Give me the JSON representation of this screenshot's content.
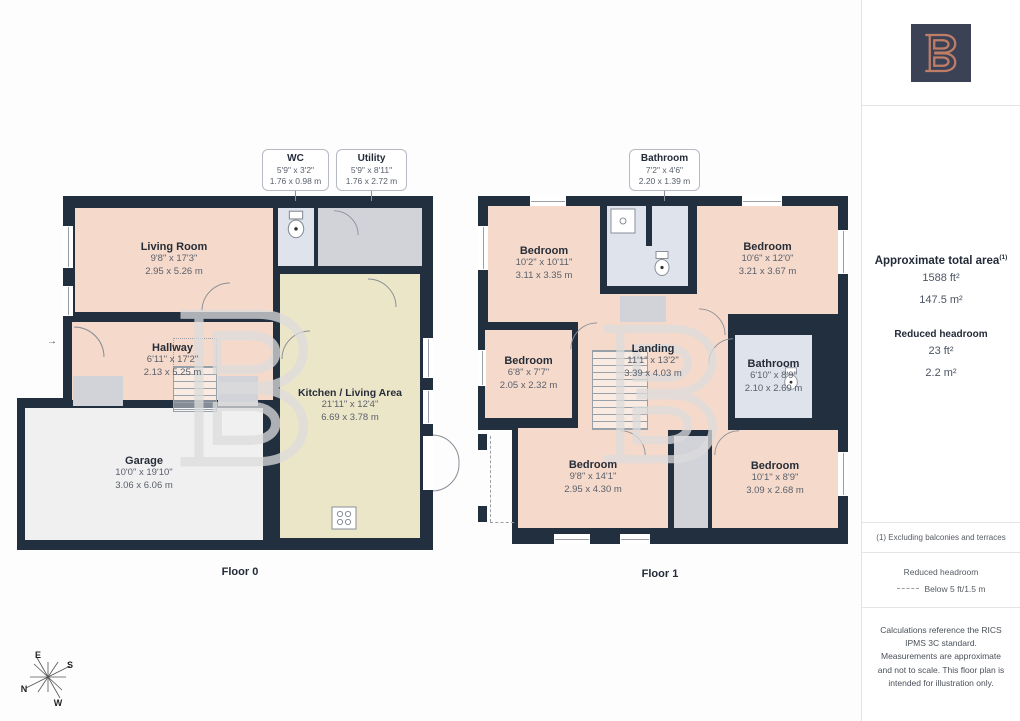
{
  "colors": {
    "wall": "#222f3f",
    "salmon": "#f5dacb",
    "cream": "#ece6c9",
    "bath": "#dfe3ec",
    "utility": "#d2d3d8",
    "garage": "#f0f0f0",
    "brand-navy": "#3b4256",
    "brand-copper": "#c07d66",
    "watermark": "#dcdcdc"
  },
  "sidebar": {
    "total_area_label": "Approximate total area",
    "total_area_sup": "(1)",
    "total_area_ft": "1588 ft²",
    "total_area_m": "147.5 m²",
    "reduced_headroom_label": "Reduced headroom",
    "reduced_headroom_ft": "23 ft²",
    "reduced_headroom_m": "2.2 m²",
    "footnote": "(1) Excluding balconies and terraces",
    "legend_title": "Reduced headroom",
    "legend_text": "Below 5 ft/1.5 m",
    "disclaimer": "Calculations reference the RICS IPMS 3C standard. Measurements are approximate and not to scale. This floor plan is intended for illustration only."
  },
  "floor0": {
    "label": "Floor 0",
    "callouts": [
      {
        "name": "WC",
        "imperial": "5'9\" x 3'2\"",
        "metric": "1.76 x 0.98 m"
      },
      {
        "name": "Utility",
        "imperial": "5'9\" x 8'11\"",
        "metric": "1.76 x 2.72 m"
      }
    ],
    "rooms": [
      {
        "name": "Living Room",
        "imperial": "9'8\" x 17'3\"",
        "metric": "2.95 x 5.26 m"
      },
      {
        "name": "Hallway",
        "imperial": "6'11\" x 17'2\"",
        "metric": "2.13 x 5.25 m"
      },
      {
        "name": "Garage",
        "imperial": "10'0\" x 19'10\"",
        "metric": "3.06 x 6.06 m"
      },
      {
        "name": "Kitchen / Living Area",
        "imperial": "21'11\" x 12'4\"",
        "metric": "6.69 x 3.78 m"
      }
    ]
  },
  "floor1": {
    "label": "Floor 1",
    "callouts": [
      {
        "name": "Bathroom",
        "imperial": "7'2\" x 4'6\"",
        "metric": "2.20 x 1.39 m"
      }
    ],
    "rooms": [
      {
        "name": "Bedroom",
        "imperial": "10'2\" x 10'11\"",
        "metric": "3.11 x 3.35 m"
      },
      {
        "name": "Bedroom",
        "imperial": "10'6\" x 12'0\"",
        "metric": "3.21 x 3.67 m"
      },
      {
        "name": "Bedroom",
        "imperial": "6'8\" x 7'7\"",
        "metric": "2.05 x 2.32 m"
      },
      {
        "name": "Landing",
        "imperial": "11'1\" x 13'2\"",
        "metric": "3.39 x 4.03 m"
      },
      {
        "name": "Bathroom",
        "imperial": "6'10\" x 8'9\"",
        "metric": "2.10 x 2.69 m"
      },
      {
        "name": "Bedroom",
        "imperial": "9'8\" x 14'1\"",
        "metric": "2.95 x 4.30 m"
      },
      {
        "name": "Bedroom",
        "imperial": "10'1\" x 8'9\"",
        "metric": "3.09 x 2.68 m"
      }
    ]
  },
  "compass": {
    "n": "N",
    "e": "E",
    "s": "S",
    "w": "W"
  }
}
